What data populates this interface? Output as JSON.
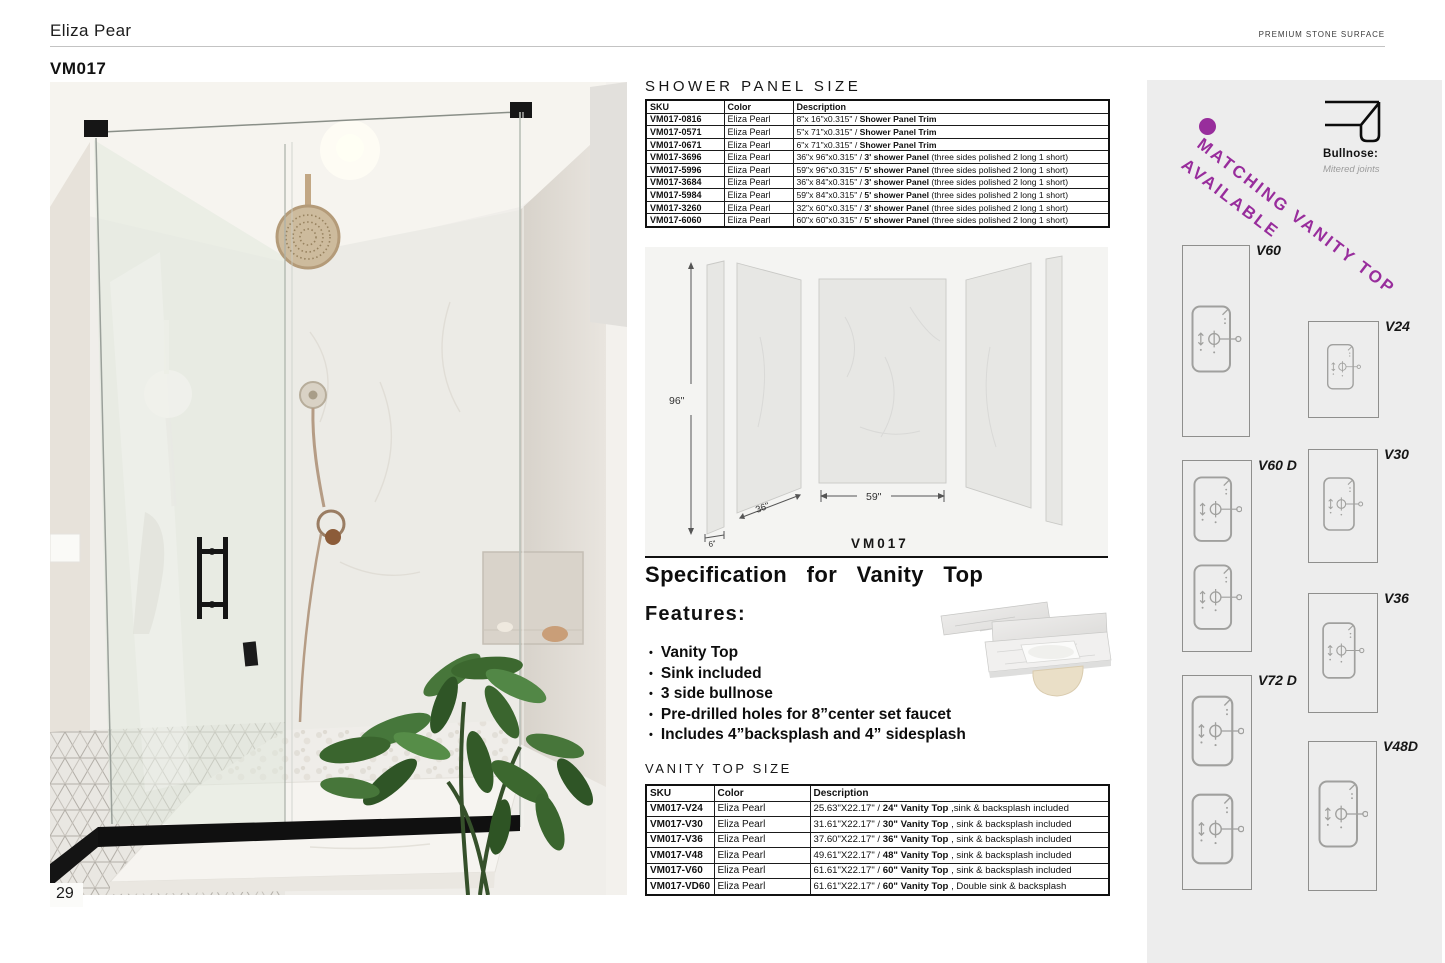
{
  "header": {
    "brand": "Eliza Pear",
    "tagline": "PREMIUM STONE SURFACE"
  },
  "model_code": "VM017",
  "page_number": "29",
  "colors": {
    "accent_purple": "#982D9C",
    "panel_bg": "#EDEDED"
  },
  "shower_section": {
    "title": "SHOWER PANEL SIZE",
    "table": {
      "columns": [
        "SKU",
        "Color",
        "Description"
      ],
      "rows": [
        {
          "sku": "VM017-0816",
          "color": "Eliza Pearl",
          "size": "8\"x 16\"x0.315\" /",
          "name": "Shower Panel Trim",
          "note": ""
        },
        {
          "sku": "VM017-0571",
          "color": "Eliza Pearl",
          "size": "5\"x 71\"x0.315\" /",
          "name": "Shower Panel Trim",
          "note": ""
        },
        {
          "sku": "VM017-0671",
          "color": "Eliza Pearl",
          "size": "6\"x 71\"x0.315\" /",
          "name": "Shower Panel Trim",
          "note": ""
        },
        {
          "sku": "VM017-3696",
          "color": "Eliza Pearl",
          "size": "36\"x 96\"x0.315\" /",
          "name": "3' shower Panel",
          "note": "(three sides polished 2 long 1 short)"
        },
        {
          "sku": "VM017-5996",
          "color": "Eliza Pearl",
          "size": "59\"x 96\"x0.315\" /",
          "name": "5' shower Panel",
          "note": "(three sides polished 2 long 1 short)"
        },
        {
          "sku": "VM017-3684",
          "color": "Eliza Pearl",
          "size": "36\"x 84\"x0.315\" /",
          "name": "3' shower Panel",
          "note": "(three sides polished 2 long 1 short)"
        },
        {
          "sku": "VM017-5984",
          "color": "Eliza Pearl",
          "size": "59\"x 84\"x0.315\" /",
          "name": "5' shower Panel",
          "note": "(three sides polished 2 long 1 short)"
        },
        {
          "sku": "VM017-3260",
          "color": "Eliza Pearl",
          "size": "32\"x 60\"x0.315\" /",
          "name": "3' shower Panel",
          "note": "(three sides polished 2 long 1 short)"
        },
        {
          "sku": "VM017-6060",
          "color": "Eliza Pearl",
          "size": "60\"x 60\"x0.315\" /",
          "name": "5' shower Panel",
          "note": "(three sides polished 2 long 1 short)"
        }
      ]
    },
    "diagram": {
      "height_label": "96\"",
      "back_width_label": "59\"",
      "side_width_label": "36\"",
      "trim_width_label": "6\"",
      "caption": "VM017"
    }
  },
  "spec_section": {
    "title": "Specification for Vanity Top",
    "features_heading": "Features:",
    "features": [
      "Vanity Top",
      "Sink included",
      "3 side bullnose",
      "Pre-drilled holes for 8”center set faucet",
      "Includes 4”backsplash and 4” sidesplash"
    ]
  },
  "vanity_section": {
    "title": "VANITY TOP SIZE",
    "table": {
      "columns": [
        "SKU",
        "Color",
        "Description"
      ],
      "rows": [
        {
          "sku": "VM017-V24",
          "color": "Eliza Pearl",
          "size": "25.63\"X22.17\"  /",
          "name": "24\" Vanity Top",
          "note": ",sink & backsplash included"
        },
        {
          "sku": "VM017-V30",
          "color": "Eliza Pearl",
          "size": "31.61\"X22.17\"  /",
          "name": "30\" Vanity Top",
          "note": ",  sink & backsplash included"
        },
        {
          "sku": "VM017-V36",
          "color": "Eliza Pearl",
          "size": "37.60\"X22.17\"  /",
          "name": "36\" Vanity Top",
          "note": ",  sink & backsplash included"
        },
        {
          "sku": "VM017-V48",
          "color": "Eliza Pearl",
          "size": "49.61\"X22.17\"  /",
          "name": "48\" Vanity Top",
          "note": ",  sink & backsplash included"
        },
        {
          "sku": "VM017-V60",
          "color": "Eliza Pearl",
          "size": "61.61\"X22.17\"  /",
          "name": "60\" Vanity Top",
          "note": ",  sink & backsplash included"
        },
        {
          "sku": "VM017-VD60",
          "color": "Eliza Pearl",
          "size": "61.61\"X22.17\"  /",
          "name": "60\" Vanity Top",
          "note": ",  Double sink & backsplash"
        }
      ]
    }
  },
  "right_panel": {
    "bullnose": {
      "label": "Bullnose:",
      "sublabel": "Mitered joints"
    },
    "badge": {
      "line1": "MATCHING VANITY TOP",
      "line2": "AVAILABLE"
    },
    "vanity_models": [
      {
        "label": "V60",
        "x": 1182,
        "y": 245,
        "w": 66,
        "h": 190,
        "sinks": 1
      },
      {
        "label": "V24",
        "x": 1308,
        "y": 321,
        "w": 69,
        "h": 95,
        "sinks": 1
      },
      {
        "label": "V60 D",
        "x": 1182,
        "y": 460,
        "w": 68,
        "h": 190,
        "sinks": 2
      },
      {
        "label": "V30",
        "x": 1308,
        "y": 449,
        "w": 68,
        "h": 112,
        "sinks": 1
      },
      {
        "label": "V36",
        "x": 1308,
        "y": 593,
        "w": 68,
        "h": 118,
        "sinks": 1
      },
      {
        "label": "V72 D",
        "x": 1182,
        "y": 675,
        "w": 68,
        "h": 213,
        "sinks": 2
      },
      {
        "label": "V48D",
        "x": 1308,
        "y": 741,
        "w": 67,
        "h": 148,
        "sinks": 1
      }
    ]
  }
}
